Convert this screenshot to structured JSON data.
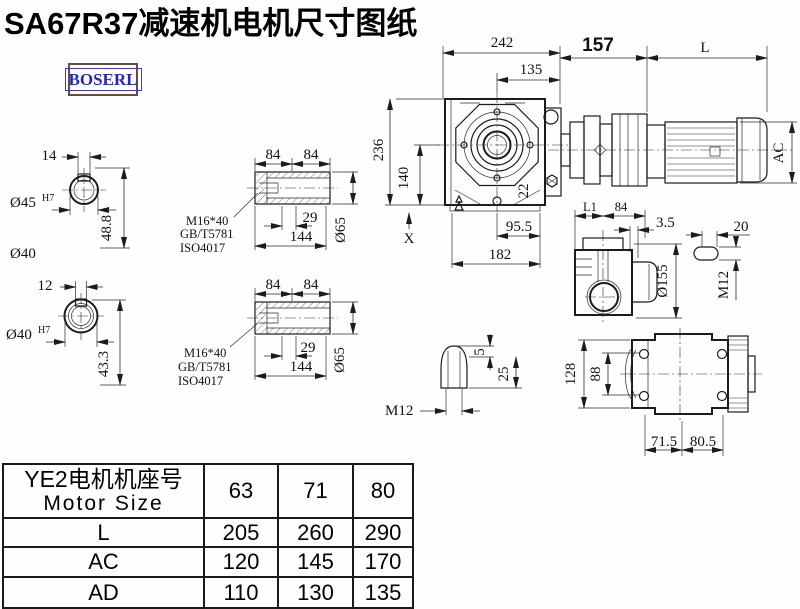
{
  "title": "SA67R37减速机电机尺寸图纸",
  "logo": "BOSERL",
  "drawing": {
    "shaft_section_1": {
      "keyway_width": "14",
      "bore": "Ø45",
      "bore_fit": "H7",
      "height": "48.8",
      "outer_dia": "Ø40"
    },
    "shaft_section_2": {
      "keyway_width": "12",
      "bore": "Ø40",
      "bore_fit": "H7",
      "height": "43.3"
    },
    "hollow_shaft_1": {
      "len_a": "84",
      "len_b": "84",
      "thread": "M16*40",
      "std_1": "GB/T5781",
      "std_2": "ISO4017",
      "thread_len": "29",
      "total_len": "144",
      "dia": "Ø65"
    },
    "hollow_shaft_2": {
      "len_a": "84",
      "len_b": "84",
      "thread": "M16*40",
      "std_1": "GB/T5781",
      "std_2": "ISO4017",
      "thread_len": "29",
      "total_len": "144",
      "dia": "Ø65"
    },
    "front_view": {
      "width": "242",
      "center_offset": "135",
      "height": "236",
      "center_height": "140",
      "bolt": "22",
      "x_mark": "X",
      "base_a": "95.5",
      "base_b": "182"
    },
    "side_assembly": {
      "gear_len": "157",
      "motor_len": "L",
      "motor_dia": "AC",
      "dim_l1": "L1",
      "dim_84": "84"
    },
    "side_view": {
      "dim_3_5": "3.5",
      "flange_dia": "Ø155"
    },
    "stud_detail": {
      "length": "20",
      "thread": "M12"
    },
    "plug_detail": {
      "tip": "5",
      "length": "25",
      "thread": "M12"
    },
    "rear_view": {
      "height": "128",
      "bolt_spacing": "88",
      "foot_a": "71.5",
      "foot_b": "80.5"
    }
  },
  "table": {
    "header": {
      "cn": "YE2电机机座号",
      "en": "Motor Size"
    },
    "columns": [
      "63",
      "71",
      "80"
    ],
    "rows": [
      {
        "label": "L",
        "values": [
          "205",
          "260",
          "290"
        ]
      },
      {
        "label": "AC",
        "values": [
          "120",
          "145",
          "170"
        ]
      },
      {
        "label": "AD",
        "values": [
          "110",
          "130",
          "135"
        ]
      }
    ]
  }
}
